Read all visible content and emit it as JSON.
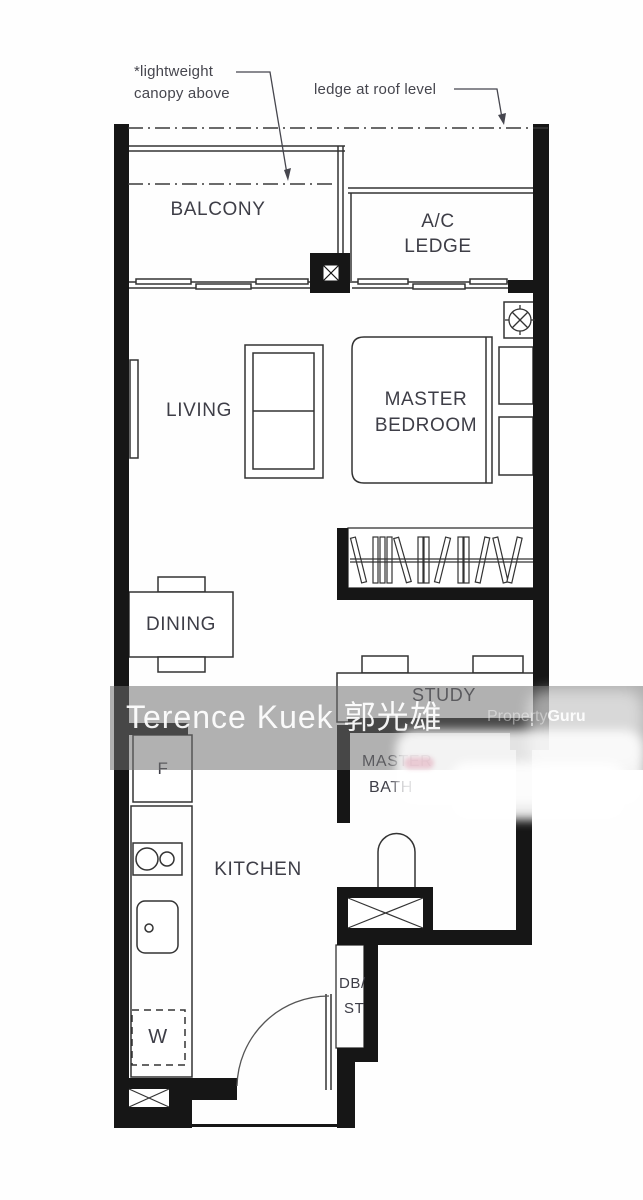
{
  "annotations": {
    "canopy_line1": "*lightweight",
    "canopy_line2": "canopy above",
    "roof_ledge": "ledge at roof level"
  },
  "rooms": {
    "balcony": "BALCONY",
    "ac_line1": "A/C",
    "ac_line2": "LEDGE",
    "living": "LIVING",
    "master_line1": "MASTER",
    "master_line2": "BEDROOM",
    "dining": "DINING",
    "study": "STUDY",
    "kitchen": "KITCHEN",
    "bath_line1": "MASTER",
    "bath_line2": "BATH",
    "db_line1": "DB/",
    "db_line2": "ST"
  },
  "appliances": {
    "fridge": "F",
    "washer": "W"
  },
  "watermark": {
    "agent": "Terence Kuek 郭光雄",
    "brand_light": "Property",
    "brand_bold": "Guru"
  },
  "colors": {
    "wall": "#161616",
    "line": "#333333",
    "label": "#3e3e47",
    "band": "#717171",
    "watermark_text": "#ffffff"
  }
}
